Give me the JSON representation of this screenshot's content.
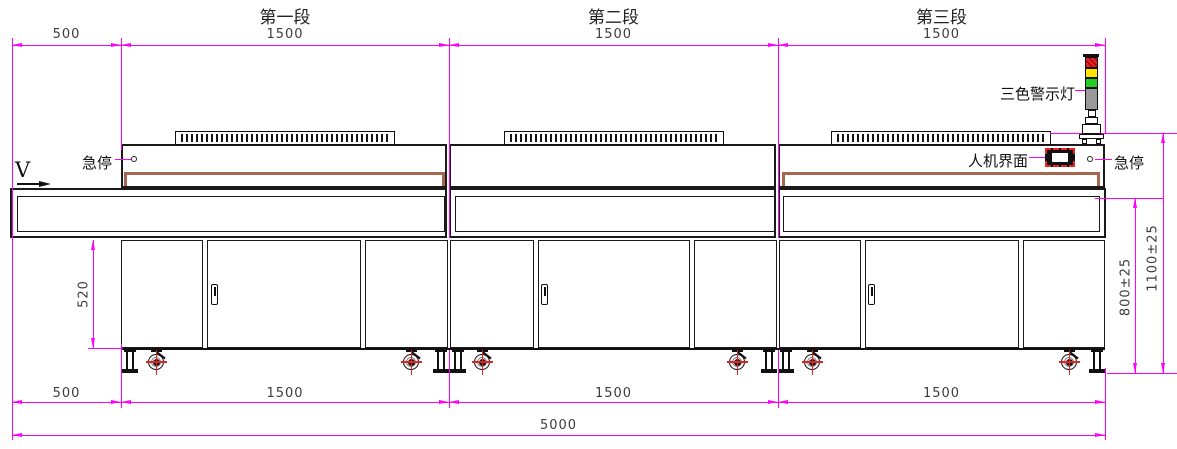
{
  "titles": [
    "第一段",
    "第二段",
    "第三段"
  ],
  "dims": {
    "top": [
      "500",
      "1500",
      "1500",
      "1500"
    ],
    "bottom": [
      "500",
      "1500",
      "1500",
      "1500"
    ],
    "overall_length": "5000",
    "cabinet_height": "520",
    "work_height": "800±25",
    "machine_height": "1100±25"
  },
  "labels": {
    "estop_left": "急停",
    "estop_right": "急停",
    "hmi": "人机界面",
    "tower_light": "三色警示灯",
    "direction": "V"
  },
  "tower_light": {
    "segments": [
      "red",
      "yellow",
      "green",
      "base-gray"
    ],
    "segment_colors": [
      "#ed1c24",
      "#ffe400",
      "#22cc22",
      "#9a9a9a"
    ]
  },
  "colors": {
    "dimension": "#ff00ff",
    "outline": "#1a1a1a",
    "rail_brown": "#a5674f",
    "centerline_red": "#e32222"
  }
}
